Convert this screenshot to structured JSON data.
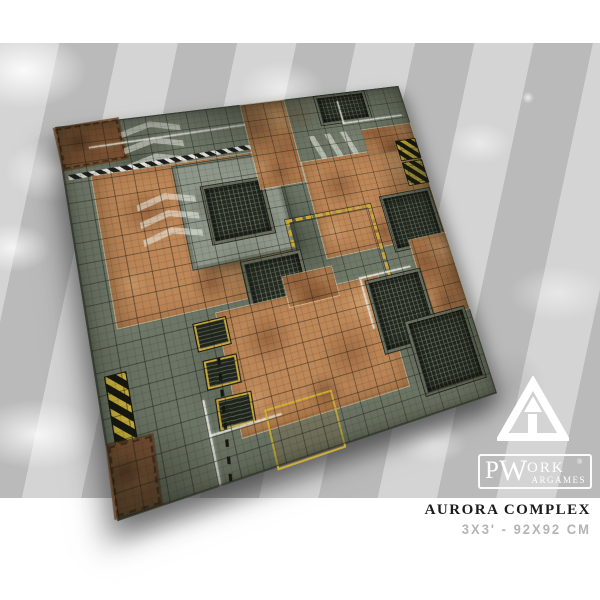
{
  "product": {
    "title": "AURORA COMPLEX",
    "size": "3x3' - 92x92 cm"
  },
  "brand": {
    "p": "P",
    "w": "W",
    "ork": "ORK",
    "registered": "®",
    "argames": "ARGAMES"
  },
  "colors": {
    "stripe_light": "#d3d4d3",
    "stripe_dark": "#b9bab9",
    "mat_base_green": "#757d6e",
    "mat_rust_orange": "#bd8758",
    "hazard_yellow": "#d6b93c",
    "grate_dark": "#23291f",
    "title_text": "#1b1b1b",
    "size_text": "#b4b4b4",
    "logo_white": "#ffffff"
  }
}
